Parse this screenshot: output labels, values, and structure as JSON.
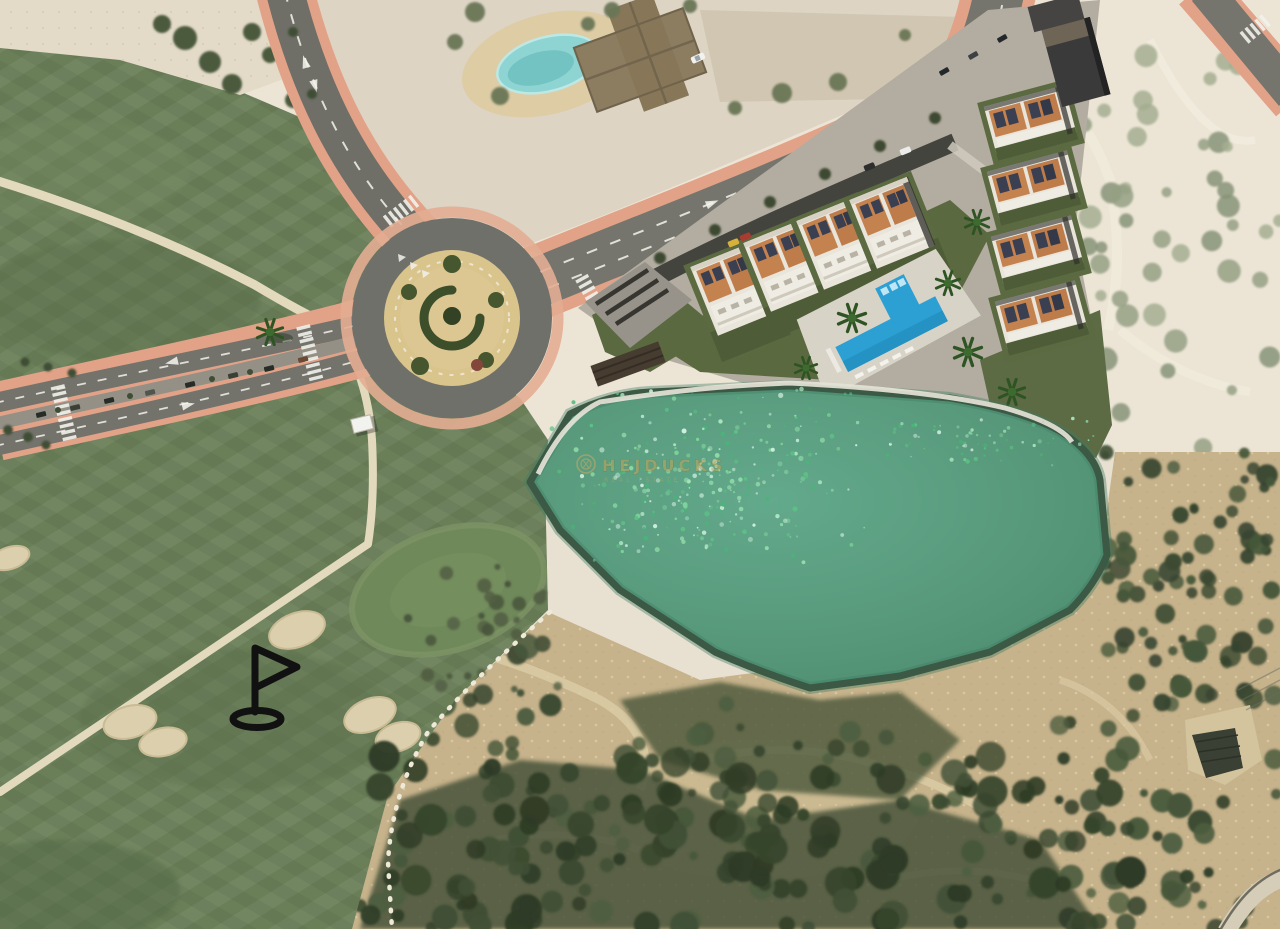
{
  "scene": {
    "type": "aerial-masterplan-photo",
    "watermark": {
      "brand": "HEJDUCKS",
      "tagline": "REAL ESTATE"
    },
    "features": {
      "golf_course": "Golf course with fairways, putting green, sand bunkers and cart paths",
      "golf_flag_marker": "Black golf flag and hole marker icon",
      "roundabout": "Landscaped traffic roundabout with spiral hedge island",
      "boulevard": "Dual carriageway boulevard with parking median and zebra crossings",
      "main_avenue": "Main avenue running along the new-build development",
      "development": "Rendered villa development: two rows of white villas with terracotta roofs and solar panels",
      "communal_pool": "Blue communal swimming pool with sun deck",
      "irrigation_lake": "Large green irrigation lake with dark embankment rim",
      "estate": "Existing private estate with kidney-shaped pool (faded area)",
      "scrubland": "Sandy scrub hillside with dense bushes"
    },
    "palette": {
      "fairway_green": "#6a7f58",
      "lake_green": "#5b9c80",
      "pool_blue": "#2c9fd3",
      "sidewalk_salmon": "#e2a288",
      "asphalt_gray": "#6f6f67",
      "sand_beige": "#e8e0d0",
      "roof_terracotta": "#c2804e",
      "watermark_gold": "#c3a75c",
      "flag_black": "#111111"
    }
  }
}
